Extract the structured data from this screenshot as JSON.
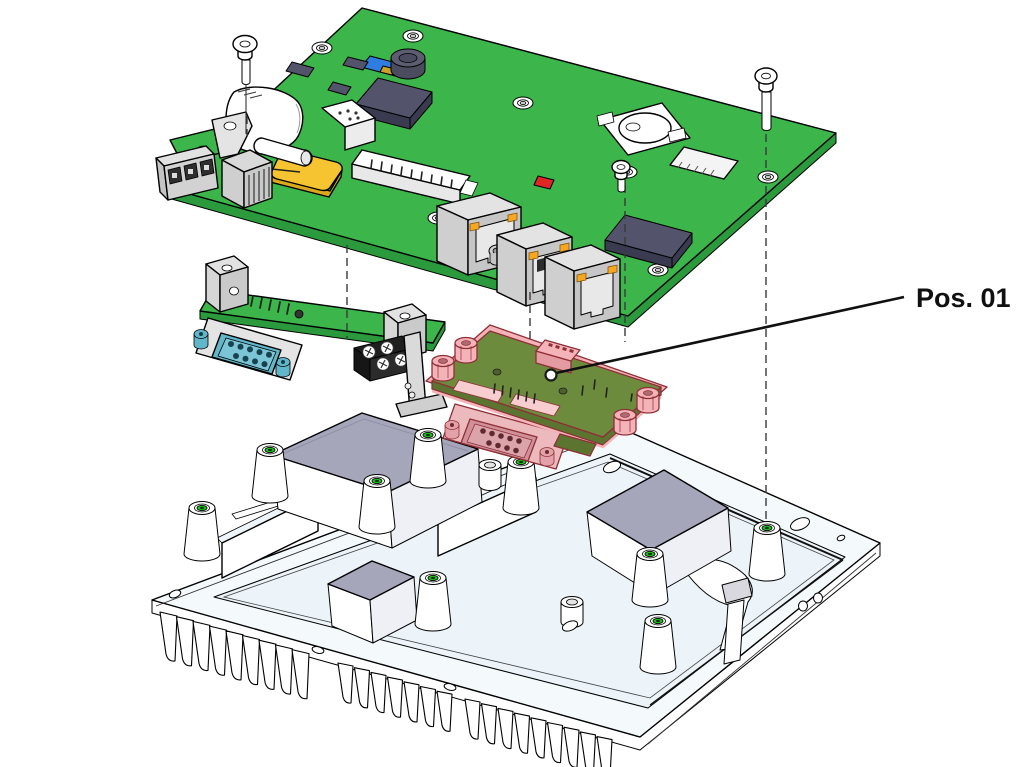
{
  "diagram": {
    "kind": "exploded-assembly-view",
    "callout": {
      "label": "Pos. 01"
    }
  },
  "parts": [
    "main-pcb",
    "serial-daughter-board",
    "highlighted-daughter-board-pos01",
    "heatsink-chassis",
    "mounting-screws",
    "assembly-axis-lines"
  ],
  "colors": {
    "pcb": "#3cb54a",
    "pcbEdge": "#2a9a3c",
    "chip": "#53536b",
    "led": "#f5a623",
    "accentRed": "#e02525",
    "accentYellow": "#f6c431",
    "accentBlue": "#2f7de0",
    "db9": "#62b6c9",
    "highlight": "#f3b3b8",
    "highlightDark": "#8f2f36",
    "highlightBoard": "#6d8b3d",
    "highlightBoardEdge": "#5b7531",
    "chassis": "#f4f9fc",
    "chassisRecess": "#ecf4fa",
    "pad": "#a6a6bb",
    "screwHoleGreen": "#15c115",
    "dashLine": "#3a3a3a",
    "leader": "#101010",
    "labelColor": "#101010",
    "background": "#ffffff"
  }
}
